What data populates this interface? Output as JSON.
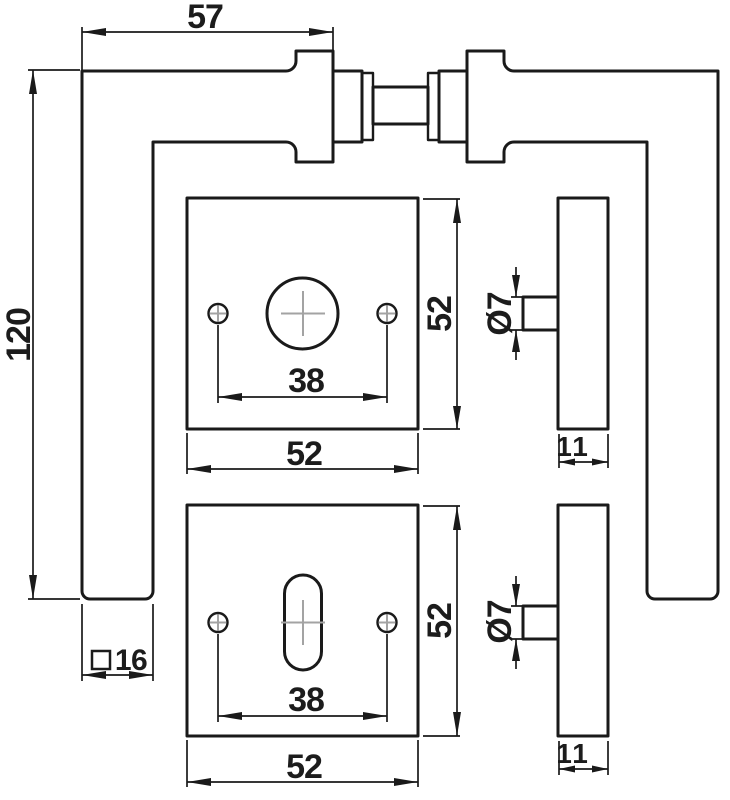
{
  "colors": {
    "line": "#1a1a1a",
    "centerline": "#a3a3a3",
    "text": "#1c1c1c",
    "background": "#ffffff"
  },
  "top_view": {
    "span": "57",
    "height": "120",
    "grip_section": {
      "symbol": "□",
      "value": "16"
    }
  },
  "rosette_top": {
    "hole_spacing": "38",
    "height": "52",
    "width": "52"
  },
  "rosette_bottom": {
    "hole_spacing": "38",
    "height": "52",
    "width": "52"
  },
  "side_top": {
    "pin": "Ø7",
    "width": "11"
  },
  "side_bottom": {
    "pin": "Ø7",
    "width": "11"
  }
}
